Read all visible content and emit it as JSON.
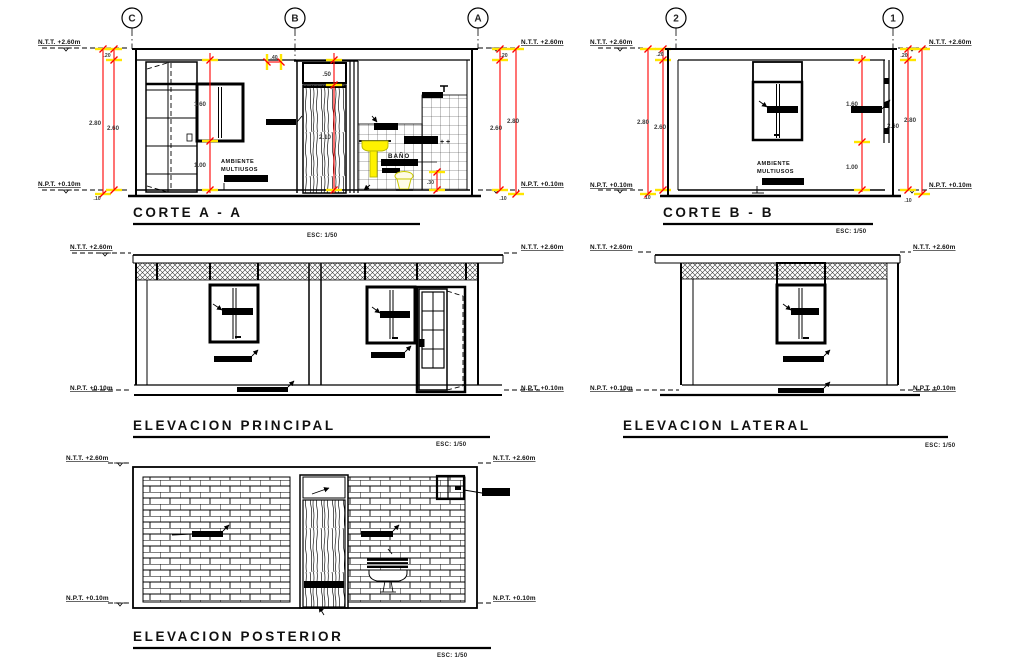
{
  "document": {
    "type": "architectural-drawing-sheet",
    "content": "building sections and elevations"
  },
  "labels": {
    "level_top": "N.T.T. +2.60m",
    "level_floor": "N.P.T. +0.10m",
    "scale": "ESC: 1/50",
    "room_line1": "AMBIENTE",
    "room_line2": "MULTIUSOS",
    "bath": "BAÑO",
    "taps": "+ +"
  },
  "views": {
    "corte_a": {
      "title": "CORTE A - A",
      "grids": [
        "C",
        "B",
        "A"
      ]
    },
    "corte_b": {
      "title": "CORTE B - B",
      "grids": [
        "2",
        "1"
      ]
    },
    "elev_principal": {
      "title": "ELEVACION PRINCIPAL"
    },
    "elev_lateral": {
      "title": "ELEVACION LATERAL"
    },
    "elev_posterior": {
      "title": "ELEVACION POSTERIOR"
    }
  },
  "dims": {
    "h020": ".20",
    "h280": "2.80",
    "h260": "2.60",
    "h160": "1.60",
    "h100": "1.00",
    "h050": ".50",
    "h210": "2.10",
    "h040": ".40",
    "h030": ".30",
    "h010": ".10"
  },
  "colors": {
    "dimension_lines": "#ff0000",
    "highlight_ticks": "#ffe600",
    "fixture_yellow": "#fff200",
    "ink": "#000000",
    "paper": "#ffffff"
  }
}
